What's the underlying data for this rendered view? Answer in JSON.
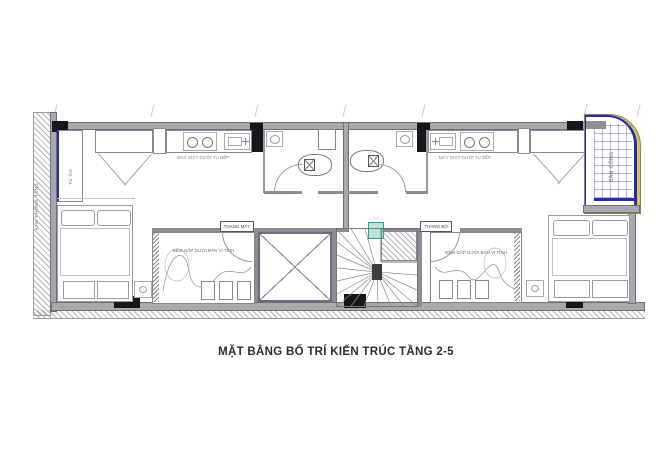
{
  "title": "MẶT BẰNG BỐ TRÍ KIẾN TRÚC TẦNG 2-5",
  "labels": {
    "ventilation_shaft": "KHE THÔNG TẦNG",
    "wardrobe": "TỦ ÁO",
    "washer_left": "MÁY GIẶT DƯỚI TỦ BẾP",
    "washer_right": "MÁY GIẶT DƯỚI TỦ BẾP",
    "elevator": "THANG MÁY",
    "stairs": "THANG BỘ",
    "balcony": "BAN CÔNG",
    "sleep_area_left": "ĐỆM GẤP DƯỚI BÀN VI TÍNH",
    "sleep_area_right": "ĐỆM GẤP DƯỚI BÀN VI TÍNH"
  },
  "colors": {
    "wall_gray": "#a8a8ae",
    "column_black": "#17171b",
    "accent_blue": "#2a2ab0",
    "accent_yellow": "#d2c65a",
    "accent_green": "#3fae96",
    "title_text": "#2b2b33"
  }
}
